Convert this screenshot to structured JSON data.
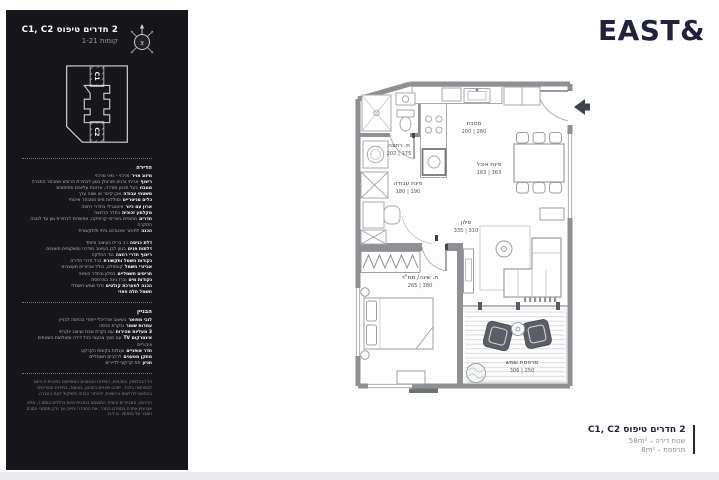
{
  "logo": {
    "text": "EAST&"
  },
  "sidebar": {
    "header": {
      "title": "2 חדרים טיפוס C1, C2",
      "floors": "קומות 1-21",
      "compass_letter": "צ"
    },
    "keyplan": {
      "unit_top": "C1",
      "unit_bottom": "C2"
    },
    "apartment_section": {
      "heading": "הדירה",
      "lines_a": [
        {
          "b": "מיזוג אויר",
          "t": "מרכזי – מיני מרכזי"
        },
        {
          "b": "ריצוף",
          "t": "אריחי גרניט פורצלן בגוון לבחירת הרוכש ממבחר החברה"
        },
        {
          "b": "מטבח",
          "t": "בעל תכנון מודרני, ארונות עליונים ותחתונים"
        },
        {
          "b": "משטחי עבודה",
          "t": "אבן קיסר או שווה ערך"
        },
        {
          "b": "כלים סניטריים",
          "t": "וסוללות מים ממבחר איכותי"
        },
        {
          "b": "ארון עם כיור",
          "t": "אינטגרלי בחדרי רחצה"
        },
        {
          "b": "מקלחון זכוכית",
          "t": "בחדר הרחצה"
        },
        {
          "b": "חדרים",
          "t": "מחופים באריחי קרמיקה, אפשרות לבחירת גוון עד לגובה התקרה"
        },
        {
          "b": "הכנה",
          "t": "לחיבור אינטרנט ביתי ולתקשורת"
        }
      ],
      "lines_b": [
        {
          "b": "דלת כניסה",
          "t": "רב בריח בעיצוב מיוחד"
        },
        {
          "b": "דלתות פנים",
          "t": "בגוון לבן בעיצוב מודרני ומשקופים תואמים"
        },
        {
          "b": "ריצוף חדרי רחצה",
          "t": "נגד החלקה"
        },
        {
          "b": "נקודות חשמל ותקשורת",
          "t": "בכל חדרי הדירה"
        },
        {
          "b": "אביזרי חשמל",
          "t": "קומפלט, כולל אביזרים מעוצבים"
        },
        {
          "b": "תריסים חשמליים",
          "t": "בסלון ובחדר השינה"
        },
        {
          "b": "נקודות מים",
          "t": "וברז גינה במרפסת"
        },
        {
          "b": "הכנה למערכת קולטים",
          "t": "ודוד שמש חשמלי"
        },
        {
          "b": "חשמל תלת פאזי",
          "t": ""
        }
      ]
    },
    "building_section": {
      "heading": "הבניין",
      "lines": [
        {
          "b": "לובי מפואר",
          "t": "בעיצוב אדריכלי ייחודי בכניסה לבניין"
        },
        {
          "b": "עמדות שומר",
          "t": "ובקרת כניסה"
        },
        {
          "b": "3 מעליות מהירות",
          "t": "עם בקרת שבת ועיצוב יוקרתי"
        },
        {
          "b": "אינטרקום TV",
          "t": "עם מסך צבעוני בכל דירה ומצלמות בשטחים ציבוריים"
        },
        {
          "b": "חדר אופניים",
          "t": "ועגלות בקומת הקרקע"
        },
        {
          "b": "מתקן מטענים",
          "t": "לרכבים חשמליים"
        },
        {
          "b": "חניון",
          "t": "תת קרקעי לדיירים"
        }
      ]
    },
    "disclaimers": [
      "כל ההדמיות, התכניות, המידות והנתונים המופיעים בתכנית זו הינם להמחשה בלבד. ייתכנו שינויים בתכנון, בעיצוב, במידות ובפריטים בהתאם לדרישות הרשויות, להיתרי הבניה ולשיקול דעת החברה.",
      "הריהוט, האביזרים והציוד המוצגים בתכנית אינם נכללים בממכר, אלא אם צוין אחרת במפרט המכר. את החברה יחייבו אך ורק מסמכי הסכם המכר על נספחיו. ט.ל.ח."
    ]
  },
  "plan": {
    "rooms": [
      {
        "name": "מטבח",
        "dims": "200 | 280"
      },
      {
        "name": "ת. רחצה",
        "dims": "202 | 175"
      },
      {
        "name": "פינת אוכל",
        "dims": "163 | 363"
      },
      {
        "name": "פינת עבודה",
        "dims": "180 | 190"
      },
      {
        "name": "סלון",
        "dims": "335 | 310"
      },
      {
        "name": "ת. שינה/ ממ\"ד",
        "dims": "265 | 380"
      },
      {
        "name": "מרפסת שמש",
        "dims": "306 | 250"
      }
    ]
  },
  "typeblock": {
    "title": "2 חדרים טיפוס C1, C2",
    "lines": [
      "שטח דירה – 58m²",
      "מרפסת – 8m²"
    ]
  }
}
